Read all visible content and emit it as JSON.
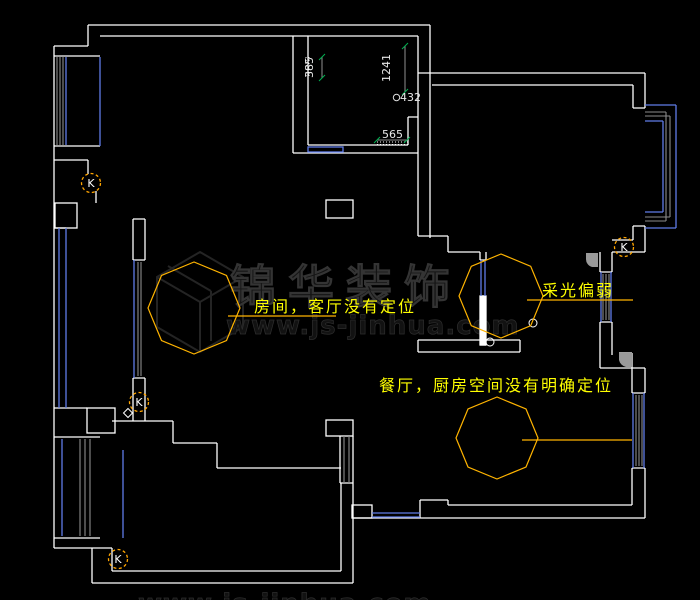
{
  "canvas": {
    "width": 700,
    "height": 600,
    "background": "#000000"
  },
  "colors": {
    "wall": "#ffffff",
    "window_blue": "#5f7ce8",
    "detail_gray": "#8c8c8c",
    "corner_fill_gray": "#9a9a9a",
    "cloud_orange": "#ffb400",
    "marker_orange": "#ffa500",
    "annotation_text_yellow": "#ffff00",
    "dimension_text": "#e8e8e8",
    "tick_green": "#00b050",
    "watermark_gray": "#1a1a1a",
    "background": "#000000"
  },
  "annotations": {
    "items": [
      {
        "id": "living-room-note",
        "text": "房间，客厅没有定位"
      },
      {
        "id": "lighting-note",
        "text": "采光偏弱"
      },
      {
        "id": "dining-kitchen-note",
        "text": "餐厅，厨房空间没有明确定位"
      }
    ]
  },
  "dimensions": {
    "items": [
      {
        "value": "385",
        "orientation": "vertical"
      },
      {
        "value": "1241",
        "orientation": "vertical"
      },
      {
        "value": "432",
        "orientation": "horizontal"
      },
      {
        "value": "565",
        "orientation": "horizontal"
      }
    ]
  },
  "markers": {
    "label": "K",
    "count": 4
  },
  "watermark": {
    "brand": "锦华装饰",
    "url": "www.js-jinhua.com"
  }
}
